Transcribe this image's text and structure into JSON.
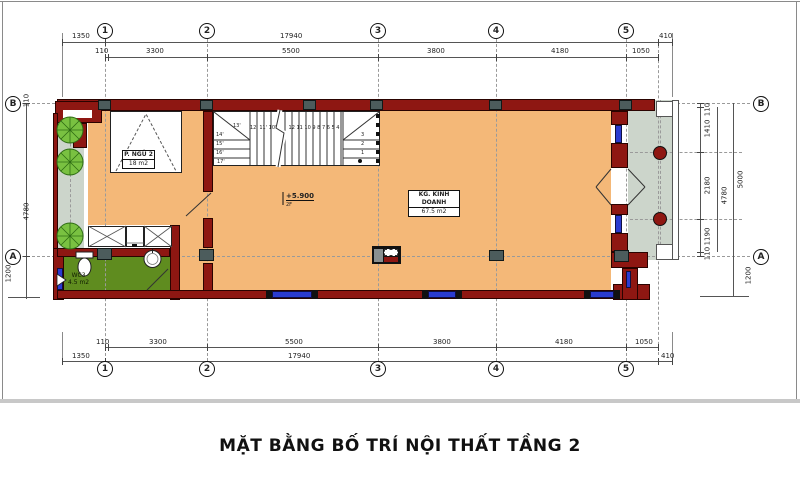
{
  "title": "MẶT BẰNG BỐ TRÍ NỘI THẤT TẦNG 2",
  "grid": {
    "columns": [
      "1",
      "2",
      "3",
      "4",
      "5"
    ],
    "rows": [
      "B",
      "A"
    ]
  },
  "dimensions": {
    "horizontal": {
      "left_offset": "1350",
      "total": "17940",
      "wall": "110",
      "seg_1_2": "3300",
      "seg_2_3": "5500",
      "seg_3_4": "3800",
      "seg_4_5": "4180",
      "seg_5_edge": "1050",
      "right_offset": "410"
    },
    "vertical": {
      "wall": "110",
      "seg_b_mid": "1410",
      "seg_mid": "2180",
      "seg_mid_a": "1190",
      "subtotal": "4780",
      "total": "5000",
      "below_a": "1200"
    }
  },
  "rooms": {
    "bedroom": {
      "name": "P. NGỦ 2",
      "area": "18 m2"
    },
    "business": {
      "name": "KG. KINH DOANH",
      "area": "67.5 m2"
    },
    "wc": {
      "name": "WC3",
      "area": "4.5 m2"
    }
  },
  "level_mark": {
    "value": "+5.900",
    "floor": "2F"
  },
  "stairs": {
    "run_upper": "12' 11' 10'",
    "run_main": "12 11 10 9 8 7 6 5 4",
    "winder_left": [
      "14'",
      "15'",
      "16'",
      "17'"
    ],
    "corner": "13'",
    "steps_right": [
      "3",
      "2",
      "1"
    ]
  },
  "colors": {
    "wall": "#8e1712",
    "floor": "#f4b878",
    "balcony": "#ccd5cb",
    "wc_floor": "#5f8c1f",
    "window": "#2b3bd0",
    "column": "#4c5c5c",
    "tree": "#79c141"
  }
}
